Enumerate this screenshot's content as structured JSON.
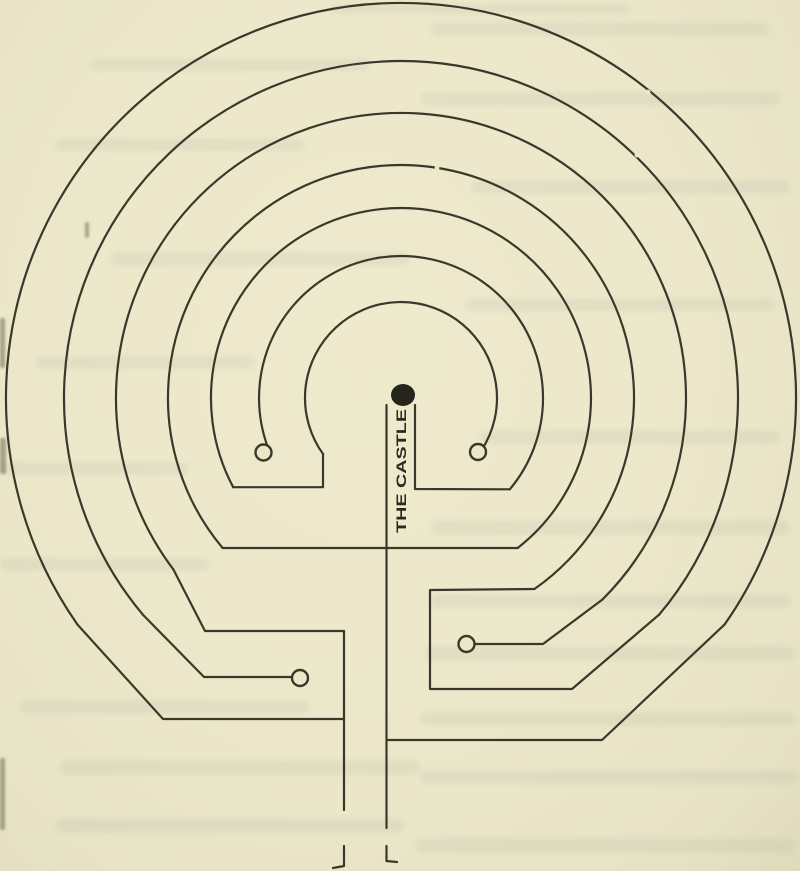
{
  "page": {
    "width": 800,
    "height": 871
  },
  "colors": {
    "paper": "#ece7c9",
    "ink": "#3b382b",
    "ink_dark": "#26251c",
    "label_ink": "#2b2920",
    "bleed_tint": "#8fa395"
  },
  "figure": {
    "label": "THE CASTLE",
    "center": {
      "x": 401,
      "y": 398
    },
    "arc_radii": [
      395,
      337,
      285,
      233,
      190,
      142,
      96
    ],
    "arcs": [
      {
        "name": "wall-arc-1-outermost",
        "r": 395,
        "x1": 77.5,
        "y1": 624.6,
        "x2": 724.5,
        "y2": 624.6
      },
      {
        "name": "wall-arc-2",
        "r": 337,
        "x1": 142.8,
        "y1": 614.6,
        "x2": 659.2,
        "y2": 614.6
      },
      {
        "name": "wall-arc-3",
        "r": 285,
        "x1": 173.4,
        "y1": 569.5,
        "x2": 602.5,
        "y2": 599.5
      },
      {
        "name": "wall-arc-4",
        "r": 233,
        "x1": 222.5,
        "y1": 547.8,
        "x2": 534.6,
        "y2": 588.9
      },
      {
        "name": "wall-arc-5",
        "r": 190,
        "x1": 233.2,
        "y1": 487.2,
        "x2": 518.0,
        "y2": 547.7
      },
      {
        "name": "wall-arc-6",
        "r": 142,
        "x1": 267.6,
        "y1": 446.6,
        "x2": 509.8,
        "y2": 489.3
      },
      {
        "name": "wall-arc-7-innermost",
        "r": 96,
        "x1": 323.3,
        "y1": 454.4,
        "x2": 481.5,
        "y2": 450.3
      }
    ],
    "walls": [
      {
        "name": "outer-right-return",
        "pts": [
          [
            724.5,
            624.6
          ],
          [
            602,
            740
          ],
          [
            387,
            740
          ]
        ]
      },
      {
        "name": "right-bay",
        "pts": [
          [
            659.2,
            614.6
          ],
          [
            572,
            689
          ],
          [
            430,
            689
          ],
          [
            430,
            590
          ],
          [
            534.6,
            589
          ]
        ]
      },
      {
        "name": "right-dead-end-stub",
        "pts": [
          [
            602.5,
            599.5
          ],
          [
            543,
            644
          ],
          [
            476,
            644
          ]
        ]
      },
      {
        "name": "middle-cross-wall",
        "pts": [
          [
            222.5,
            548
          ],
          [
            518,
            548
          ]
        ]
      },
      {
        "name": "inner-left-link",
        "pts": [
          [
            233.2,
            487.2
          ],
          [
            323,
            487.2
          ],
          [
            323,
            454.4
          ]
        ]
      },
      {
        "name": "castle-right-wall",
        "pts": [
          [
            509.8,
            489.3
          ],
          [
            415,
            489
          ],
          [
            415,
            405
          ]
        ]
      },
      {
        "name": "left-dead-end-stub",
        "pts": [
          [
            142.8,
            614.6
          ],
          [
            204,
            677
          ],
          [
            291.5,
            677
          ]
        ]
      },
      {
        "name": "left-entry-wall",
        "pts": [
          [
            173.4,
            569.5
          ],
          [
            205,
            631
          ],
          [
            344,
            631
          ],
          [
            344,
            810
          ]
        ]
      },
      {
        "name": "left-entry-foot",
        "pts": [
          [
            344,
            846
          ],
          [
            344,
            866
          ],
          [
            333,
            868
          ]
        ]
      },
      {
        "name": "outer-left-return",
        "pts": [
          [
            77.5,
            624.6
          ],
          [
            163,
            719
          ],
          [
            344,
            719
          ]
        ]
      },
      {
        "name": "castle-left-wall",
        "pts": [
          [
            386.5,
            405
          ],
          [
            386.5,
            828
          ]
        ]
      },
      {
        "name": "right-entry-foot",
        "pts": [
          [
            386.5,
            846
          ],
          [
            386.5,
            861
          ],
          [
            397,
            862
          ]
        ]
      }
    ],
    "dead_end_circles": [
      {
        "name": "dead-end-ring-inner-left",
        "cx": 263.5,
        "cy": 452.5,
        "r": 8
      },
      {
        "name": "dead-end-ring-inner-right",
        "cx": 478,
        "cy": 452,
        "r": 8
      },
      {
        "name": "dead-end-ring-lower-right",
        "cx": 466.5,
        "cy": 644,
        "r": 8
      },
      {
        "name": "dead-end-ring-lower-left",
        "cx": 300,
        "cy": 678,
        "r": 8
      }
    ],
    "castle_dot": {
      "cx": 403,
      "cy": 395,
      "rx": 12,
      "ry": 11
    },
    "label_anchor": {
      "x": 406,
      "y": 533,
      "rotate": -90,
      "length": 124,
      "font_size": 14
    },
    "scan_gaps": [
      {
        "x": 648,
        "y": 92
      },
      {
        "x": 637,
        "y": 155
      },
      {
        "x": 475,
        "y": 172
      },
      {
        "x": 437,
        "y": 168
      },
      {
        "x": 543,
        "y": 203
      },
      {
        "x": 500,
        "y": 113
      }
    ],
    "stroke_width": 2.2
  },
  "paper_artifacts": {
    "bleed_bars": [
      [
        330,
        4,
        300,
        10
      ],
      [
        430,
        22,
        340,
        14
      ],
      [
        90,
        58,
        280,
        13
      ],
      [
        420,
        92,
        360,
        14
      ],
      [
        55,
        138,
        250,
        13
      ],
      [
        470,
        180,
        320,
        14
      ],
      [
        110,
        252,
        300,
        14
      ],
      [
        465,
        298,
        310,
        13
      ],
      [
        35,
        356,
        220,
        13
      ],
      [
        480,
        430,
        300,
        14
      ],
      [
        0,
        462,
        190,
        13
      ],
      [
        430,
        520,
        360,
        15
      ],
      [
        0,
        558,
        210,
        13
      ],
      [
        430,
        594,
        360,
        14
      ],
      [
        425,
        646,
        370,
        15
      ],
      [
        20,
        700,
        290,
        14
      ],
      [
        420,
        712,
        375,
        14
      ],
      [
        60,
        760,
        360,
        15
      ],
      [
        420,
        770,
        378,
        14
      ],
      [
        55,
        818,
        350,
        15
      ],
      [
        415,
        838,
        380,
        15
      ]
    ],
    "edge_marks": [
      [
        0,
        318,
        5,
        50
      ],
      [
        0,
        438,
        6,
        36
      ],
      [
        85,
        222,
        4,
        16
      ],
      [
        0,
        758,
        5,
        72
      ]
    ]
  }
}
